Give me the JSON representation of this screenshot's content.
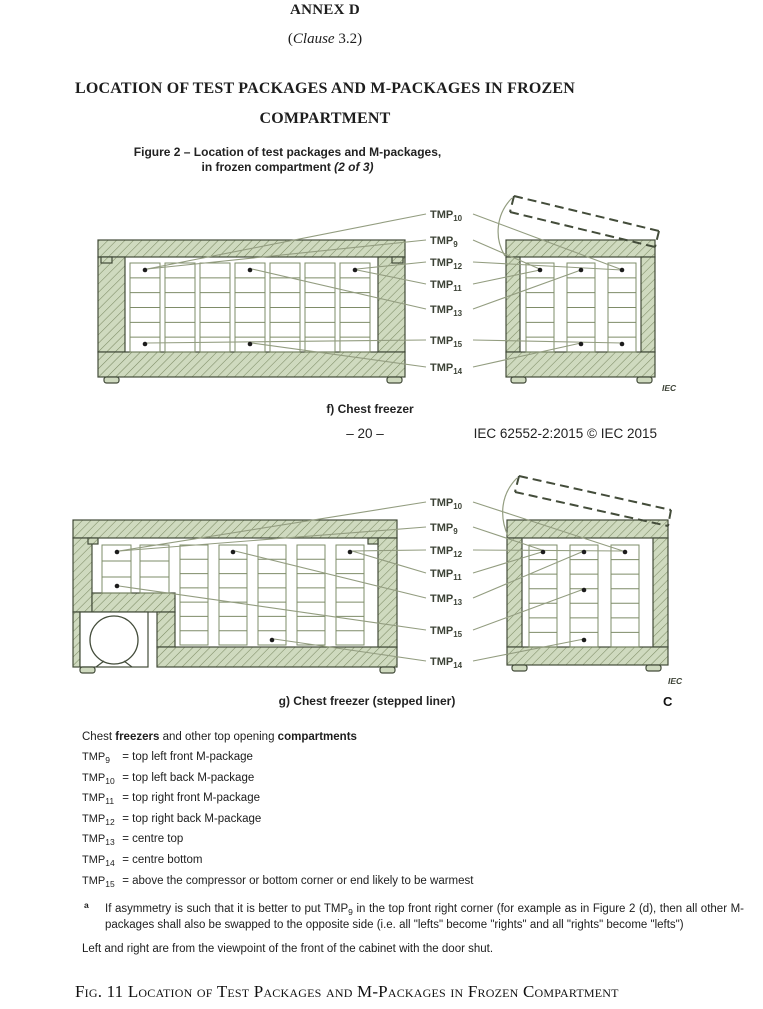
{
  "page": {
    "annex": "ANNEX D",
    "clause_prefix": "(",
    "clause_italic": "Clause",
    "clause_suffix": " 3.2)",
    "title_line1": "LOCATION OF TEST PACKAGES AND M-PACKAGES IN FROZEN",
    "title_line2": "COMPARTMENT",
    "running_page_number": "– 20 –",
    "running_doc_ref": "IEC 62552-2:2015 © IEC 2015",
    "side_letter": "C",
    "bottom_caption": "Fig. 11 Location of Test Packages and M-Packages in Frozen Compartment"
  },
  "figure2": {
    "caption_line1": "Figure 2 – Location of test packages and M-packages,",
    "caption_line2_regular": "in frozen compartment ",
    "caption_line2_italic": "(2 of 3)",
    "subfigures": [
      {
        "id": "f",
        "caption": "f) Chest freezer",
        "iec": "IEC",
        "tmp_labels": [
          {
            "text": "TMP",
            "sub": "10"
          },
          {
            "text": "TMP",
            "sub": "9"
          },
          {
            "text": "TMP",
            "sub": "12"
          },
          {
            "text": "TMP",
            "sub": "11"
          },
          {
            "text": "TMP",
            "sub": "13"
          },
          {
            "text": "TMP",
            "sub": "15"
          },
          {
            "text": "TMP",
            "sub": "14"
          }
        ]
      },
      {
        "id": "g",
        "caption": "g) Chest freezer (stepped liner)",
        "iec": "IEC",
        "tmp_labels": [
          {
            "text": "TMP",
            "sub": "10"
          },
          {
            "text": "TMP",
            "sub": "9"
          },
          {
            "text": "TMP",
            "sub": "12"
          },
          {
            "text": "TMP",
            "sub": "11"
          },
          {
            "text": "TMP",
            "sub": "13"
          },
          {
            "text": "TMP",
            "sub": "15"
          },
          {
            "text": "TMP",
            "sub": "14"
          }
        ]
      }
    ]
  },
  "legend": {
    "heading_parts": [
      {
        "text": "Chest ",
        "bold": false
      },
      {
        "text": "freezers",
        "bold": true
      },
      {
        "text": " and other top opening ",
        "bold": false
      },
      {
        "text": "compartments",
        "bold": true
      }
    ],
    "items": [
      {
        "name": "TMP",
        "sub": "9",
        "desc": "= top left front M-package"
      },
      {
        "name": "TMP",
        "sub": "10",
        "desc": "= top left back M-package"
      },
      {
        "name": "TMP",
        "sub": "11",
        "desc": "= top right front M-package"
      },
      {
        "name": "TMP",
        "sub": "12",
        "desc": "= top right back M-package"
      },
      {
        "name": "TMP",
        "sub": "13",
        "desc": "= centre top"
      },
      {
        "name": "TMP",
        "sub": "14",
        "desc": "= centre bottom"
      },
      {
        "name": "TMP",
        "sub": "15",
        "desc": "= above the compressor or bottom corner or end likely to be warmest"
      }
    ],
    "footnote": {
      "marker": "a",
      "pre": "If asymmetry is such that it is better to put TMP",
      "sub": "9",
      "post": " in the top front right corner (for example as in Figure 2 (d), then all other M-packages shall also be swapped to the opposite side (i.e. all \"lefts\" become \"rights\" and all \"rights\" become \"lefts\")"
    },
    "viewpoint_note": "Left and right are from the viewpoint of the front of the cabinet with the door shut."
  },
  "colors": {
    "hatch_fill": "#cfdabf",
    "hatch_line": "#7c8b64",
    "outline": "#434c3a",
    "package_line": "#7e8c68",
    "leader": "#939d80",
    "dot": "#1c1c1c",
    "label_text": "#3c4236"
  }
}
